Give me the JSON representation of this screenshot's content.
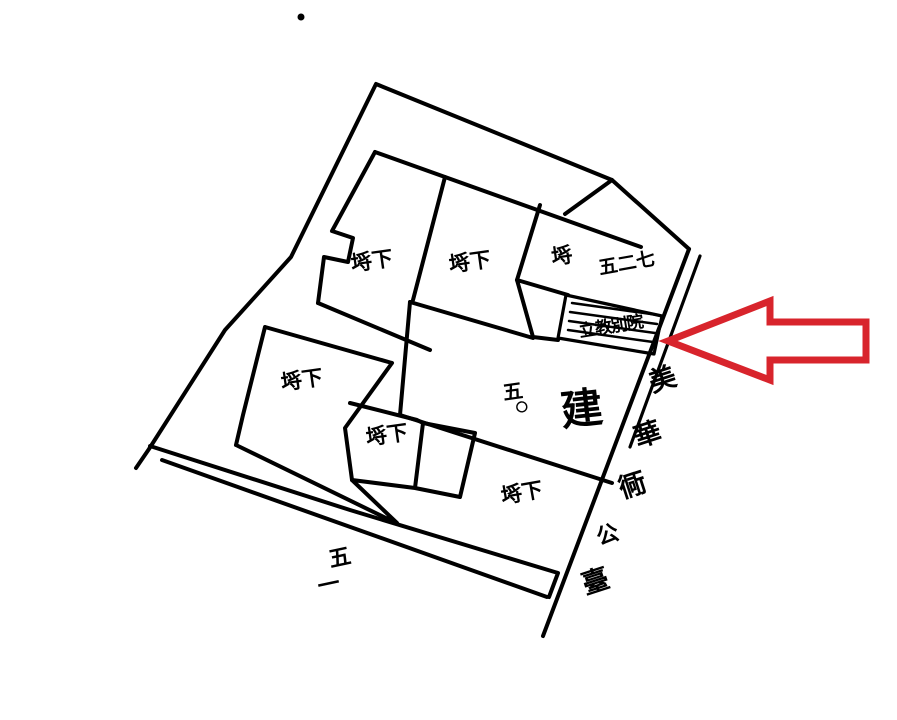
{
  "map": {
    "background_color": "#ffffff",
    "ink_color": "#000000",
    "arrow": {
      "color": "#d8242c",
      "direction": "left",
      "style": "outline"
    },
    "parcel_labels": {
      "top_row_1": "埓下",
      "top_row_2": "埓下",
      "top_row_3": "埓",
      "top_right_lot": "五二七",
      "left_parcel": "埓下",
      "mid_parcel": "埓下",
      "bottom_parcel": "埓下",
      "target_parcel": "立教別院",
      "center_lot_chars": [
        "五",
        "〇"
      ],
      "center_use": "建",
      "bottom_lot_chars": [
        "五",
        "一"
      ]
    },
    "street_chars": [
      "美",
      "華",
      "衕",
      "公",
      "臺"
    ]
  }
}
